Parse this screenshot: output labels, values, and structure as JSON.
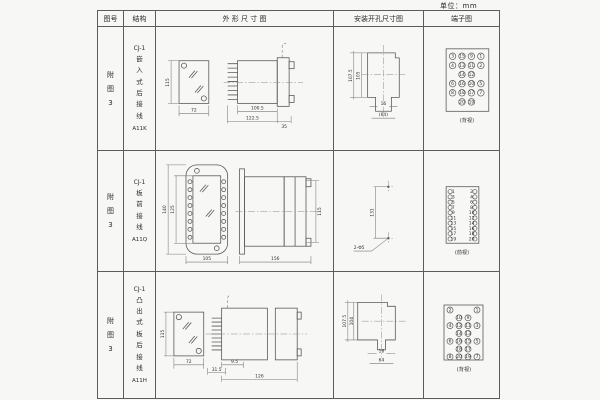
{
  "unit_label": "单位：mm",
  "header": {
    "fig_no": "图号",
    "structure": "结构",
    "outline": "外 形 尺 寸 图",
    "mounting": "安装开孔尺寸图",
    "terminal": "端子图"
  },
  "rows": [
    {
      "fig_no": "附图3",
      "model": "CJ-1",
      "structure": "嵌入式后接线",
      "code": "A11K",
      "outline": {
        "front_h": "115",
        "front_w": "72",
        "body_len": "100.5",
        "total_len": "122.5",
        "flange": "35"
      },
      "mounting": {
        "v_outer": "107.5",
        "v_inner": "105",
        "h_small": "16",
        "h_large": "(64)"
      },
      "terminal": {
        "view": "(背视)",
        "grid": [
          [
            "3",
            "15",
            "9",
            "1"
          ],
          [
            "4",
            "13",
            "11",
            "2"
          ],
          [
            "",
            "14",
            "12",
            ""
          ],
          [
            "6",
            "16",
            "10",
            "5"
          ],
          [
            "8",
            "18",
            "17",
            "7"
          ],
          [
            "",
            "20",
            "19",
            ""
          ]
        ]
      }
    },
    {
      "fig_no": "附图3",
      "model": "CJ-1",
      "structure": "板前接线",
      "code": "A11Q",
      "outline": {
        "front_h_outer": "140",
        "front_h_inner": "125",
        "front_w": "105",
        "side_len": "156",
        "side_h": "115"
      },
      "mounting": {
        "v": "131",
        "holes": "2-Φ5"
      },
      "terminal": {
        "view": "(前视)",
        "pairs": [
          [
            "1",
            "2"
          ],
          [
            "3",
            "4"
          ],
          [
            "5",
            "6"
          ],
          [
            "7",
            "8"
          ],
          [
            "9",
            "10"
          ],
          [
            "11",
            "12"
          ],
          [
            "13",
            "14"
          ],
          [
            "15",
            "16"
          ],
          [
            "17",
            "18"
          ],
          [
            "19",
            "20"
          ]
        ]
      }
    },
    {
      "fig_no": "附图3",
      "model": "CJ-1",
      "structure": "凸出式板后接线",
      "code": "A11H",
      "outline": {
        "front_h": "115",
        "front_w": "72",
        "pins_len": "9.5",
        "base_len": "31.5",
        "total_len": "126"
      },
      "mounting": {
        "v_outer": "107.5",
        "v_inner": "104",
        "h_small": "16",
        "h_large": "64"
      },
      "terminal": {
        "view": "(背视)",
        "grid": [
          [
            "2",
            "",
            "",
            "1"
          ],
          [
            "",
            "10",
            "9",
            ""
          ],
          [
            "4",
            "12",
            "11",
            "3"
          ],
          [
            "",
            "14",
            "13",
            ""
          ],
          [
            "6",
            "16",
            "15",
            "5"
          ],
          [
            "",
            "18",
            "17",
            ""
          ],
          [
            "8",
            "20",
            "19",
            "7"
          ]
        ]
      }
    }
  ]
}
